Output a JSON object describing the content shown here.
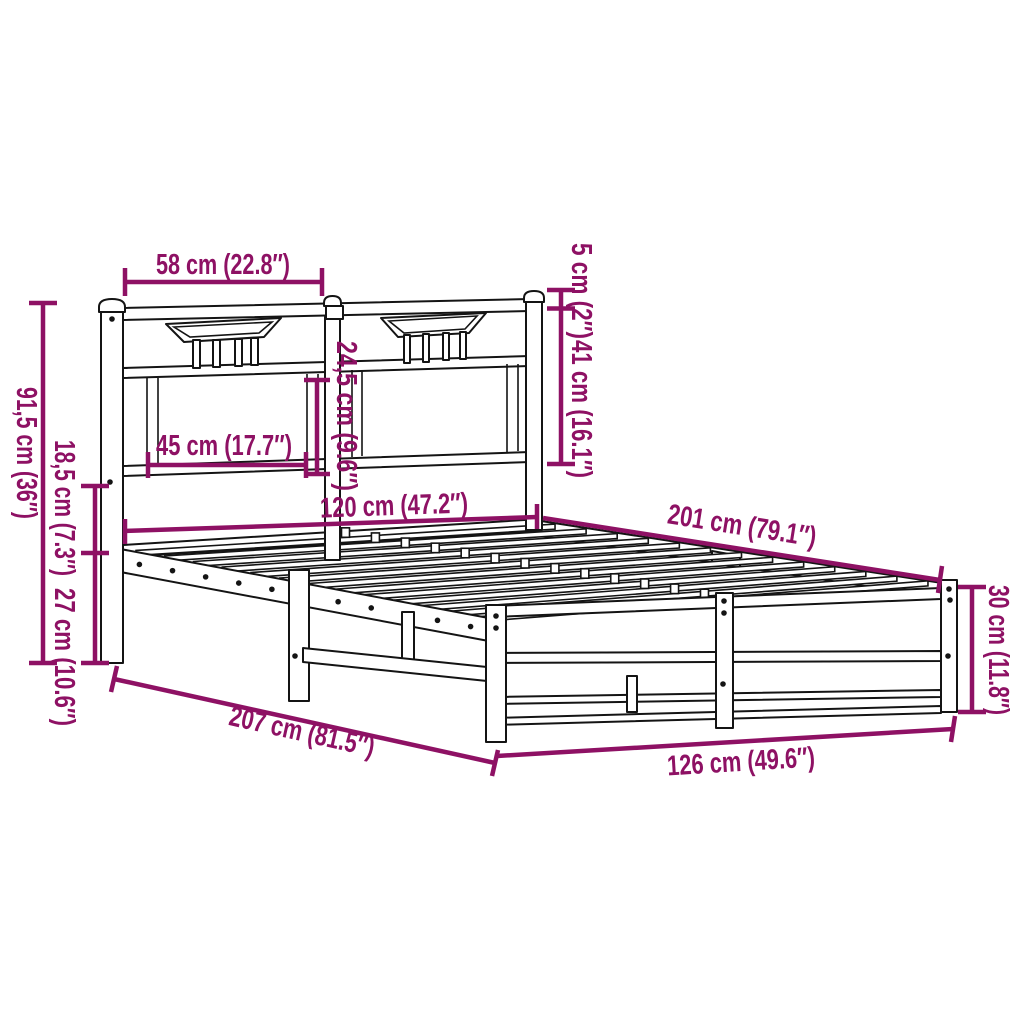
{
  "diagram": {
    "subject": "metal bed frame with headboard and footboard, technical dimension drawing",
    "background_color": "#ffffff",
    "outline_color": "#141414",
    "dimension_color": "#8e1164"
  },
  "dims": {
    "d58": "58 cm (22.8″)",
    "d5": "5 cm (2″)",
    "d41": "41 cm (16.1″)",
    "d24_5": "24,5 cm (9.6″)",
    "d45": "45 cm (17.7″)",
    "d120": "120 cm (47.2″)",
    "d201": "201 cm (79.1″)",
    "d91_5": "91,5 cm (36″)",
    "d18_5": "18,5 cm (7.3″)",
    "d27": "27 cm (10.6″)",
    "d207": "207 cm (81.5″)",
    "d126": "126 cm (49.6″)",
    "d30": "30 cm (11.8″)"
  }
}
